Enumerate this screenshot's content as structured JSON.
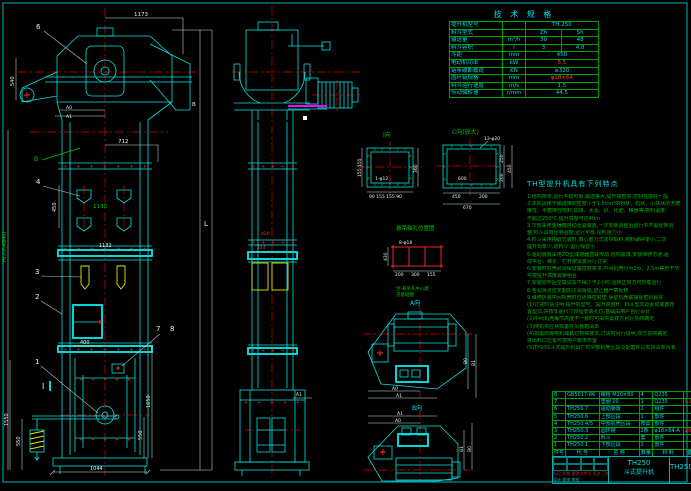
{
  "colors": {
    "bg": "#000000",
    "line_cyan": "#00e2e2",
    "centerline_red": "#e00000",
    "note_green": "#00b400",
    "bucket_yellow": "#e6e600",
    "accent_magenta": "#ff00ff",
    "text_white": "#eeeeee"
  },
  "spec": {
    "title": "技 术 规 格",
    "rows": [
      {
        "label": "提升机型号",
        "unit": "",
        "v1": "TH 250",
        "v2": ""
      },
      {
        "label": "料斗型式",
        "unit": "",
        "v1": "Zh",
        "v2": "Sh"
      },
      {
        "label": "输送量",
        "unit": "m³/h",
        "v1": "30",
        "v2": "48"
      },
      {
        "label": "料斗容积",
        "unit": "l",
        "v1": "3",
        "v2": "4.8"
      },
      {
        "label": "斗距",
        "unit": "mm",
        "v1": "450",
        "v2": ""
      },
      {
        "label": "电动机功率",
        "unit": "kW",
        "v1": "5.5",
        "v2": ""
      },
      {
        "label": "链条破断载荷",
        "unit": "KN",
        "v1": "≥320",
        "v2": ""
      },
      {
        "label": "圆环链规格",
        "unit": "mm",
        "v1": "φ18×64",
        "v2": ""
      },
      {
        "label": "料斗运行速度",
        "unit": "m/s",
        "v1": "1.5",
        "v2": ""
      },
      {
        "label": "传动轴转速",
        "unit": "r/min",
        "v1": "44.5",
        "v2": ""
      }
    ]
  },
  "notes": {
    "title": "TH型提升机具有下列特点",
    "lines": [
      "1.结构简单,运行平稳可靠,输送量大,提升高度高,密封性能好一般",
      "2.本机适用于输送堆积密度小于1.5t/m³的粉状、粒状、小块状的无磨",
      "  琢性、半磨琢性物料,如煤、水泥、砂、化肥、粮食等,物料温度",
      "  不超过250℃,提升高度可达40m",
      "3.下部采用重锤箱自动张紧装置,一次安装调整后运行中不需经常调",
      "  整,料斗具有足够强度,运行可靠,挖料阻力小",
      "4.料斗采用掏取式装料,离心重力式诱导卸料,物料破碎率小,二次",
      "  提升现象少,返料少,运行噪音小",
      "5.驱动装置采用ZQ型减速器直联传动,结构紧凑,安装维修方便,驱",
      "  动平台、梯子、栏杆按需要另行订货",
      "6.安装时机壳必须保证垂直度要求,中间机壳分为2m、2.5m等若干节",
      "  可按提升高度需要组合",
      "7.安装完毕后空载试车不得少于2小时,运转正常方可负载运行",
      "8.各润滑点应定期加注润滑脂,逆止器严禁反转",
      "9.维修拆装中间机壳时应更换密封垫,保证机壳联接处密封良好",
      "",
      "(1)订货时请注明:提升机型号、提升高度H、料斗型式及驱动装置布",
      "   置型式,并按本图尺寸预留安装孔位,基础由用户自行设计",
      "(2)中间机壳每节高度不一致时可由供需双方另行协商确定",
      "(3)随机供应易损备件见装箱清单",
      "(4)如需防爆电机或其它特殊要求,订货时另行说明,双方协商确定,",
      "   进出料口位置可按用户要求布置",
      "",
      "(5)TH250斗式提升机出厂时中部机壳区段及配套件以发货清单为准。"
    ]
  },
  "bom": {
    "headers": [
      "件号",
      "代  号",
      "名  称",
      "数量",
      "材  料",
      "备注"
    ],
    "rows": [
      [
        "8",
        "GB5017-86",
        "螺栓 M20×80",
        "4",
        "Q235",
        ""
      ],
      [
        "7",
        "",
        "垫圈 20",
        "1",
        "Q235",
        "9.0"
      ],
      [
        "6",
        "TH250.7",
        "驱动装置",
        "1",
        "组件",
        ""
      ],
      [
        "5",
        "TH250.6",
        "上部区段",
        "1",
        "部件",
        ""
      ],
      [
        "4",
        "TH250.4/5",
        "中部机壳区段",
        "按需",
        "部件",
        ""
      ],
      [
        "3",
        "TH250.3",
        "圆环链",
        "2条",
        "φ18×64-A",
        "205"
      ],
      [
        "2",
        "TH250.2",
        "料斗",
        "套",
        "部件",
        ""
      ],
      [
        "1",
        "TH250.1",
        "下部区段",
        "1",
        "部件",
        ""
      ]
    ]
  },
  "title_block": {
    "model": "TH250",
    "name": "斗式提升机",
    "dwg_no": "TH250",
    "rev_row": "标记 处数 更改文件号 签名 日期",
    "sign_row": "设计  校核  审核"
  },
  "labels": {
    "dim1173": "1173",
    "part6": "6",
    "dim540": "540",
    "a0": "A0",
    "a1": "A1",
    "bRight": "B",
    "dim712": "712",
    "flagB": "B",
    "part4": "4",
    "dim450": "450",
    "dim1130": "1130",
    "dim1132": "1132",
    "part3": "3",
    "part2": "2",
    "dim400": "400",
    "part7": "7",
    "part8": "8",
    "secI": "I",
    "part1": "1",
    "dim1550": "1550",
    "dim550L": "550",
    "dim1650": "1650",
    "dim550R": "550",
    "dim1044": "1044",
    "axisH": "H(大约4840)",
    "axisL": "L",
    "red420": "420",
    "red444": "444",
    "a1mid": "A1",
    "viewI": "I向",
    "iInner": "1-φ12",
    "i360": "360",
    "iBottom": "90 155 155 90",
    "iLeft": "155 155",
    "viewC": "C向(放大)",
    "cBolt": "13-φ20",
    "cInner": "600",
    "cB1": "450",
    "cB2": "200",
    "cTotal": "670",
    "cR1": "250",
    "cR2": "200",
    "cR3": "450",
    "detTitle": "悬吊轴孔位置图",
    "detBolt": "8-φ18",
    "detL": "430",
    "detB1": "200",
    "detB2": "300",
    "detB3": "155",
    "detN1": "注:悬吊孔中心距",
    "detN2": "见基础图",
    "viewA": "A向",
    "aA0": "A0",
    "aA1": "A1",
    "aB0": "B0",
    "aB1": "B1",
    "viewB": "B向",
    "bA1": "A1",
    "bA0": "A0",
    "bB0": "B0",
    "bB1": "B1"
  }
}
